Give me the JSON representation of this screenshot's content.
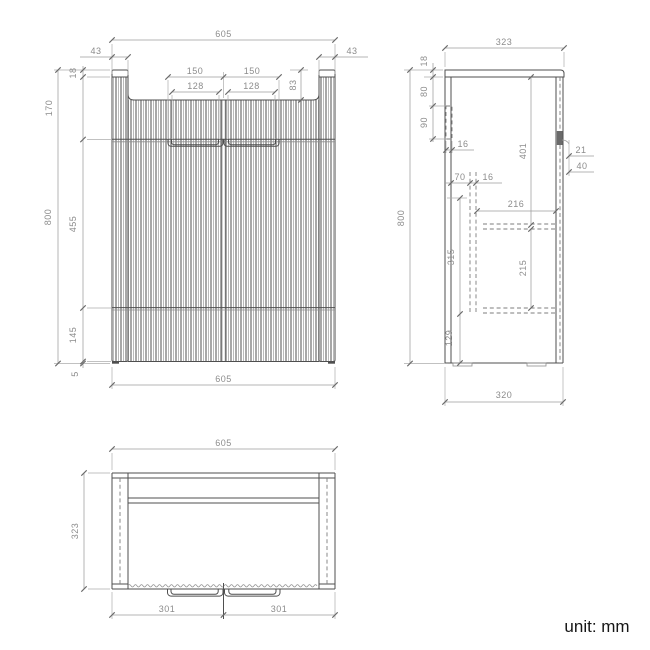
{
  "note": {
    "unit_label": "unit: mm"
  },
  "colors": {
    "outline": "#4f4f4f",
    "dimension_line": "#9c9c9c",
    "dimension_text": "#8c8c8c",
    "flute_dark": "#3c3c3c",
    "flute_light": "#a8a8a8",
    "background": "#ffffff",
    "note_text": "#161616"
  },
  "front_view": {
    "width_top": "605",
    "side_panel_left": "43",
    "side_panel_right": "43",
    "top_thickness": "18",
    "upper_section_height": "170",
    "recess_depth": "83",
    "handle_outer_left": "150",
    "handle_outer_right": "150",
    "handle_inner_left": "128",
    "handle_inner_right": "128",
    "overall_height": "800",
    "door_height": "455",
    "drawer_height": "145",
    "base_gap": "5",
    "width_bottom": "605"
  },
  "side_view": {
    "depth_top": "323",
    "top_thickness": "18",
    "bracket_offset": "80",
    "bracket_height": "90",
    "bracket_thickness": "16",
    "interior_height": "401",
    "door_thickness": "21",
    "handle_depth": "40",
    "back_offset": "70",
    "panel_thickness": "16",
    "interior_depth": "216",
    "drawer_box_height": "315",
    "shelf_clearance": "215",
    "base_height": "129",
    "overall_height": "800",
    "depth_bottom": "320"
  },
  "top_view": {
    "width": "605",
    "depth": "323",
    "door_left": "301",
    "door_right": "301"
  }
}
